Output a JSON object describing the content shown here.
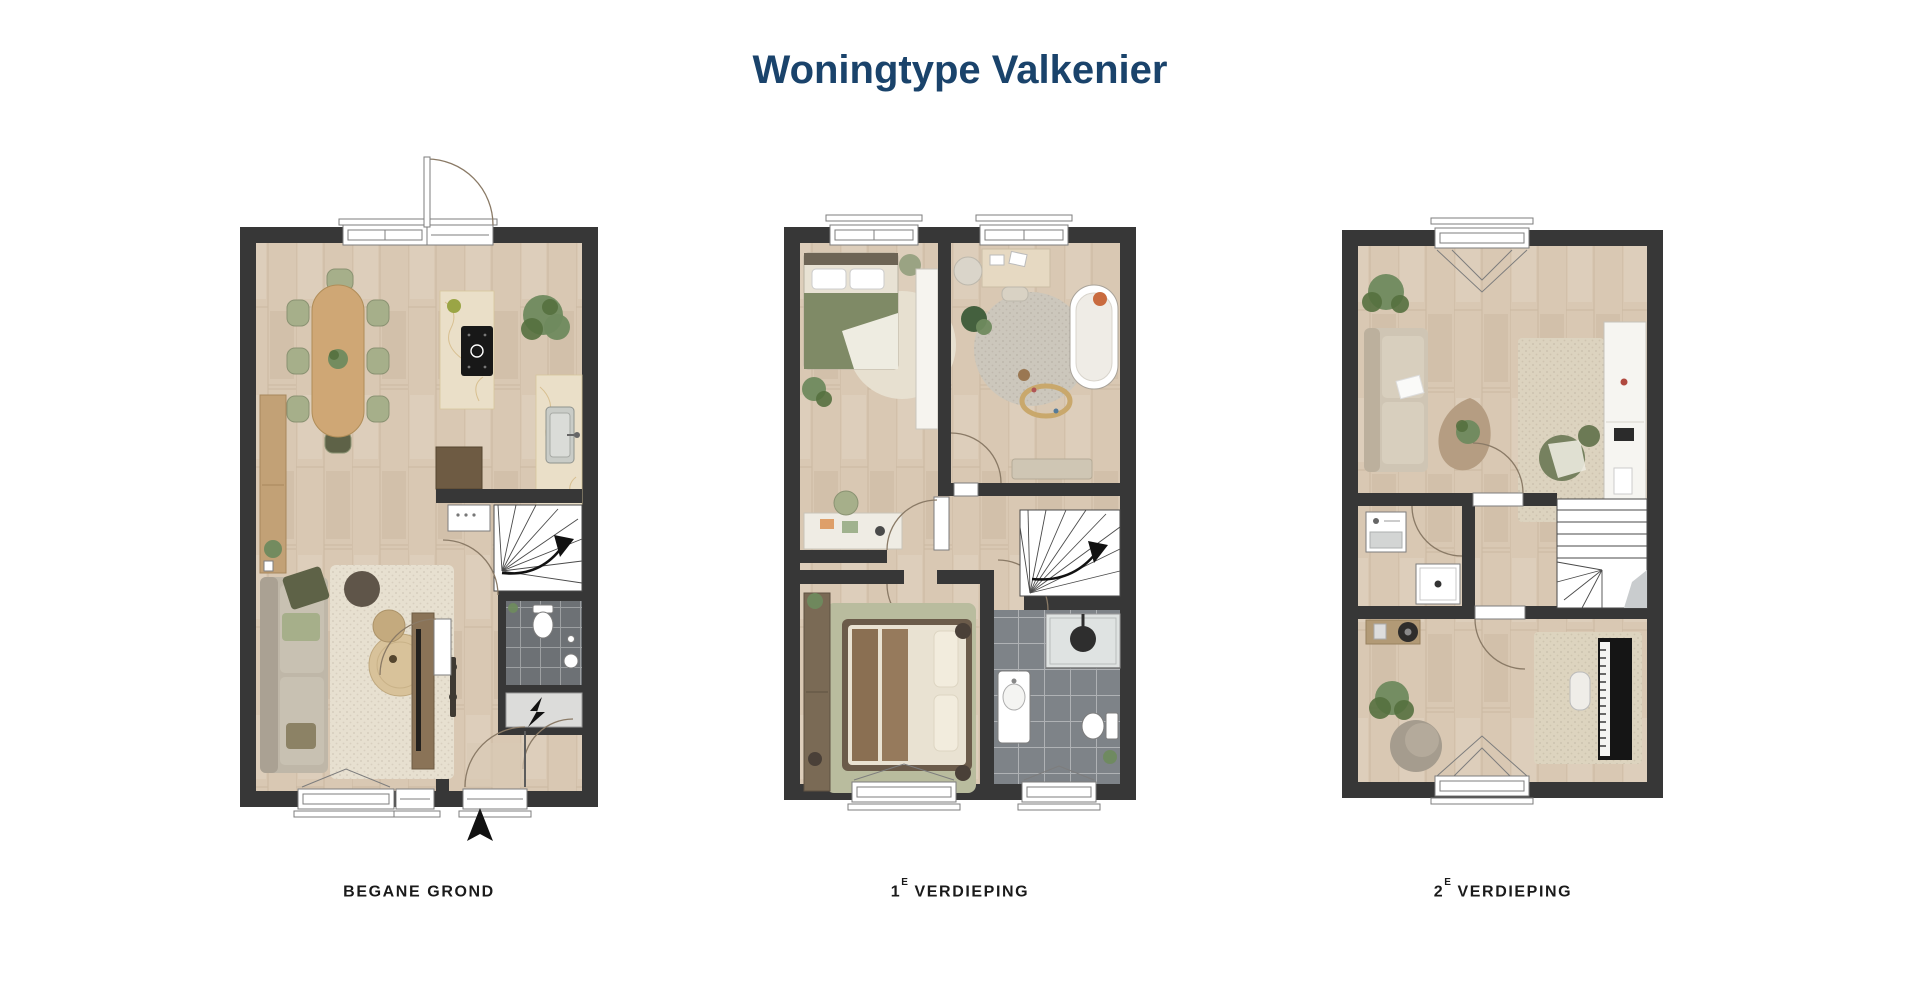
{
  "title": "Woningtype Valkenier",
  "palette": {
    "title_color": "#1a436b",
    "label_color": "#1a1a1a",
    "wall": "#373737",
    "floor_wood": "#d9c8b3",
    "floor_line": "#b5a186",
    "marble": "#eadfc8",
    "wood_furniture": "#cfa775",
    "green_seat": "#a6af8a",
    "green_plant": "#6f8a5e",
    "rug_cream": "#e7e0d0",
    "rug_gray": "#ccc7bc",
    "rug_green": "#b9bc9e",
    "sofa": "#bfb7a8",
    "tile_dark": "#6d7175",
    "tile_bath": "#7e8388",
    "bed_green": "#7f8a66",
    "door_arc": "#8a7a66"
  },
  "floors": [
    {
      "id": "begane-grond",
      "label_main": "BEGANE GROND",
      "label_sup": "",
      "label_tail": ""
    },
    {
      "id": "1e-verdieping",
      "label_main": "1",
      "label_sup": "E",
      "label_tail": "VERDIEPING"
    },
    {
      "id": "2e-verdieping",
      "label_main": "2",
      "label_sup": "E",
      "label_tail": "VERDIEPING"
    }
  ],
  "compass": {
    "icon": "north-arrow"
  }
}
